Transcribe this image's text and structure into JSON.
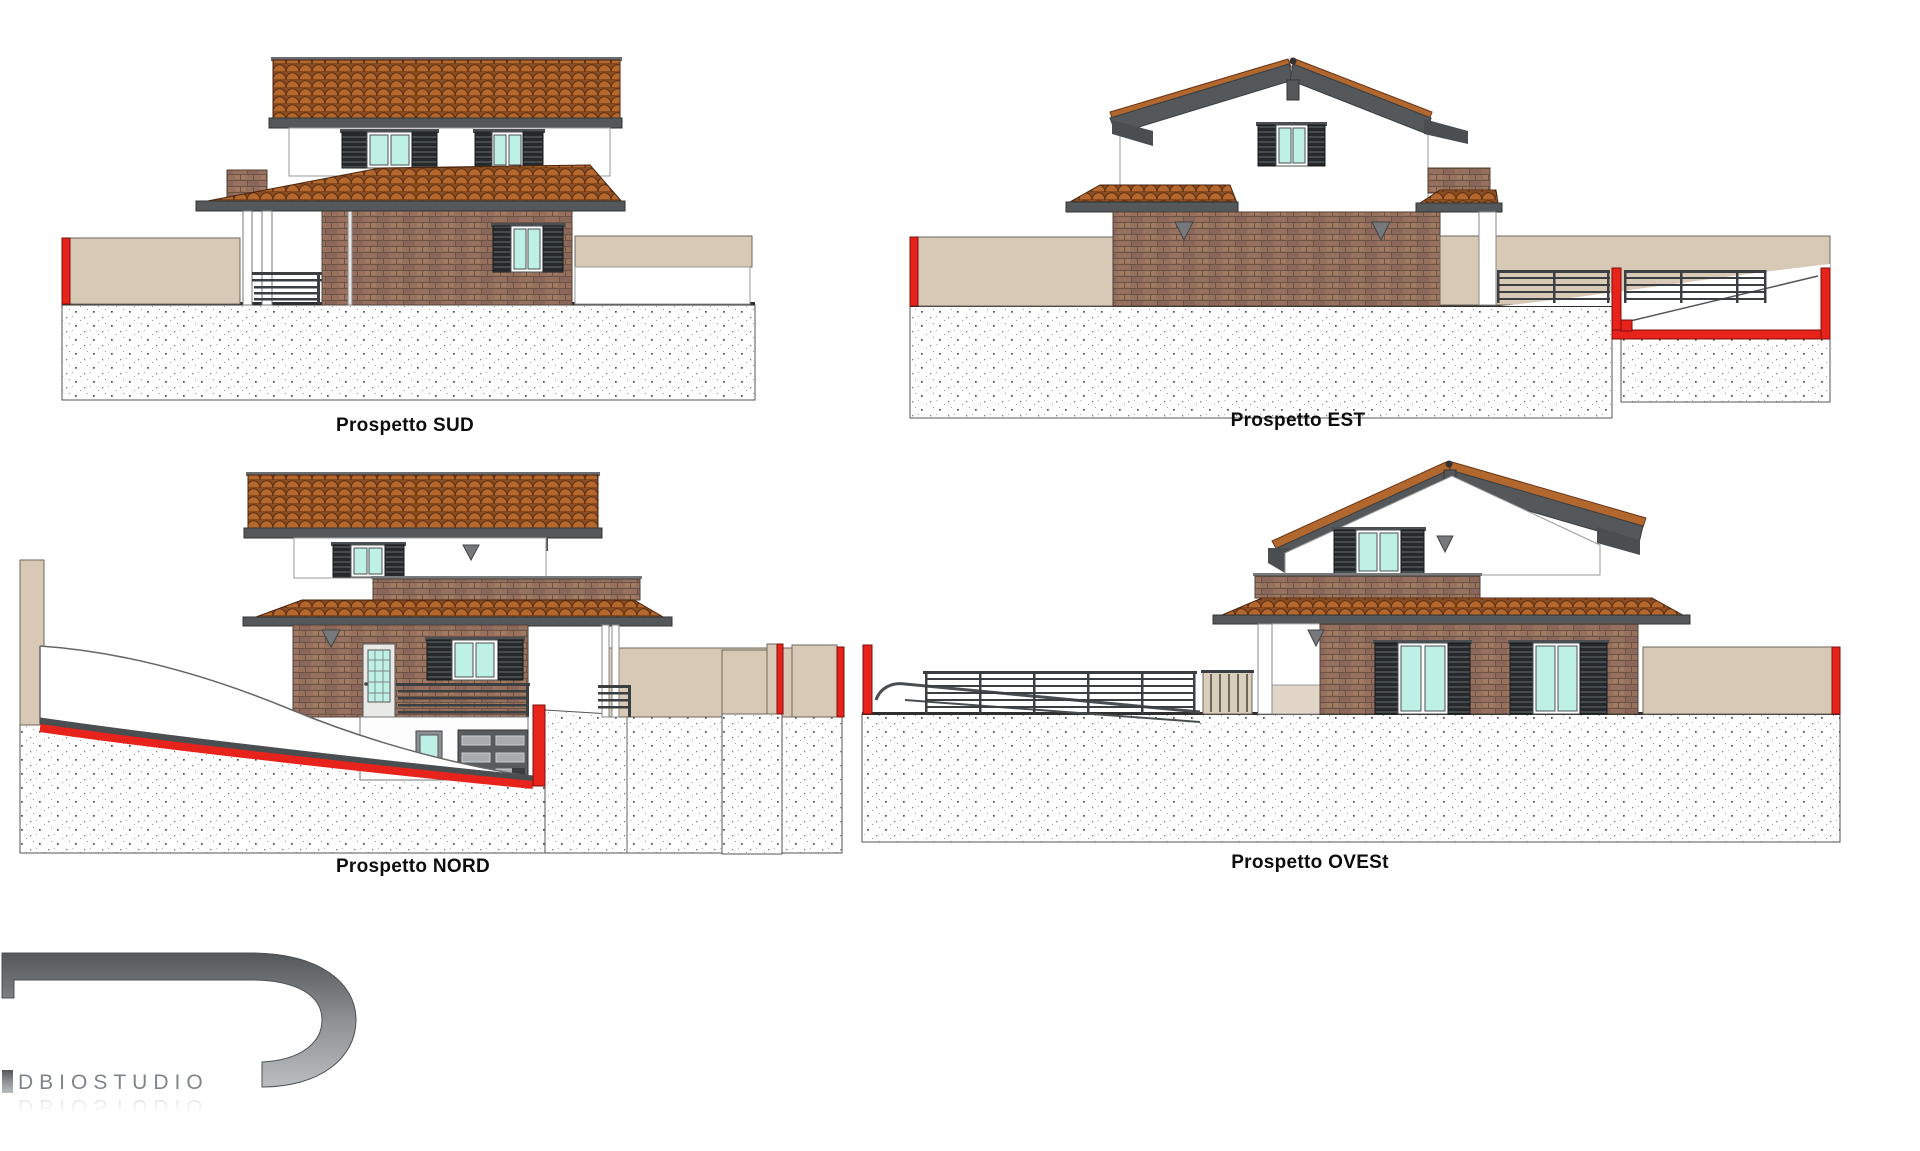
{
  "drawing": {
    "elevations": [
      {
        "id": "sud",
        "label": "Prospetto SUD"
      },
      {
        "id": "est",
        "label": "Prospetto EST"
      },
      {
        "id": "nord",
        "label": "Prospetto NORD"
      },
      {
        "id": "ovest",
        "label": "Prospetto OVESt"
      }
    ],
    "logo": {
      "text": "DBIOSTUDIO",
      "reflection_text": "DBIOSTUDIO"
    },
    "colors": {
      "background": "#ffffff",
      "section_cut_red": "#e8231c",
      "roof_tile_terracotta": "#b2672e",
      "brick_wall": "#97715d",
      "boundary_wall_beige": "#d8c9b7",
      "fascia_gray": "#54585a",
      "window_glass_cyan": "#bff0e6",
      "shutter_dark": "#25292b",
      "logo_gray": "#7f8488"
    }
  }
}
